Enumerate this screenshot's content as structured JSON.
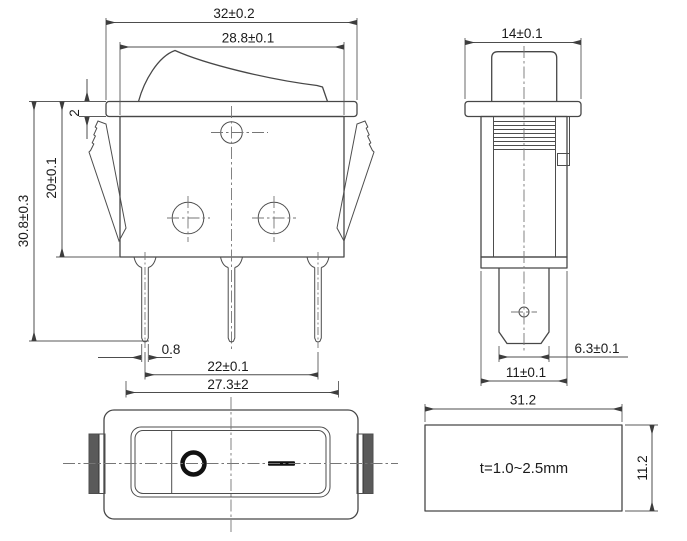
{
  "drawing": {
    "type": "rocker-switch-dimension-drawing",
    "views": {
      "front": {
        "width_overall": "32±0.2",
        "width_body": "28.8±0.1",
        "flange_thickness": "2",
        "body_depth": "20±0.1",
        "overall_height": "30.8±0.3",
        "pin_thickness": "0.8",
        "pin_pitch": "22±0.1",
        "pin_span": "27.3±2"
      },
      "side": {
        "width": "14±0.1",
        "terminal_width": "6.3±0.1",
        "body_width": "11±0.1"
      },
      "top": {
        "off_symbol": "O",
        "on_symbol": "—"
      },
      "panel_cutout": {
        "width": "31.2",
        "height": "11.2",
        "thickness_note": "t=1.0~2.5mm"
      }
    },
    "colors": {
      "line": "#474747",
      "centerline": "#767676",
      "text": "#1b1b1b",
      "clip_fill": "#5a5a5a",
      "symbol": "#111111",
      "background": "#ffffff"
    }
  }
}
